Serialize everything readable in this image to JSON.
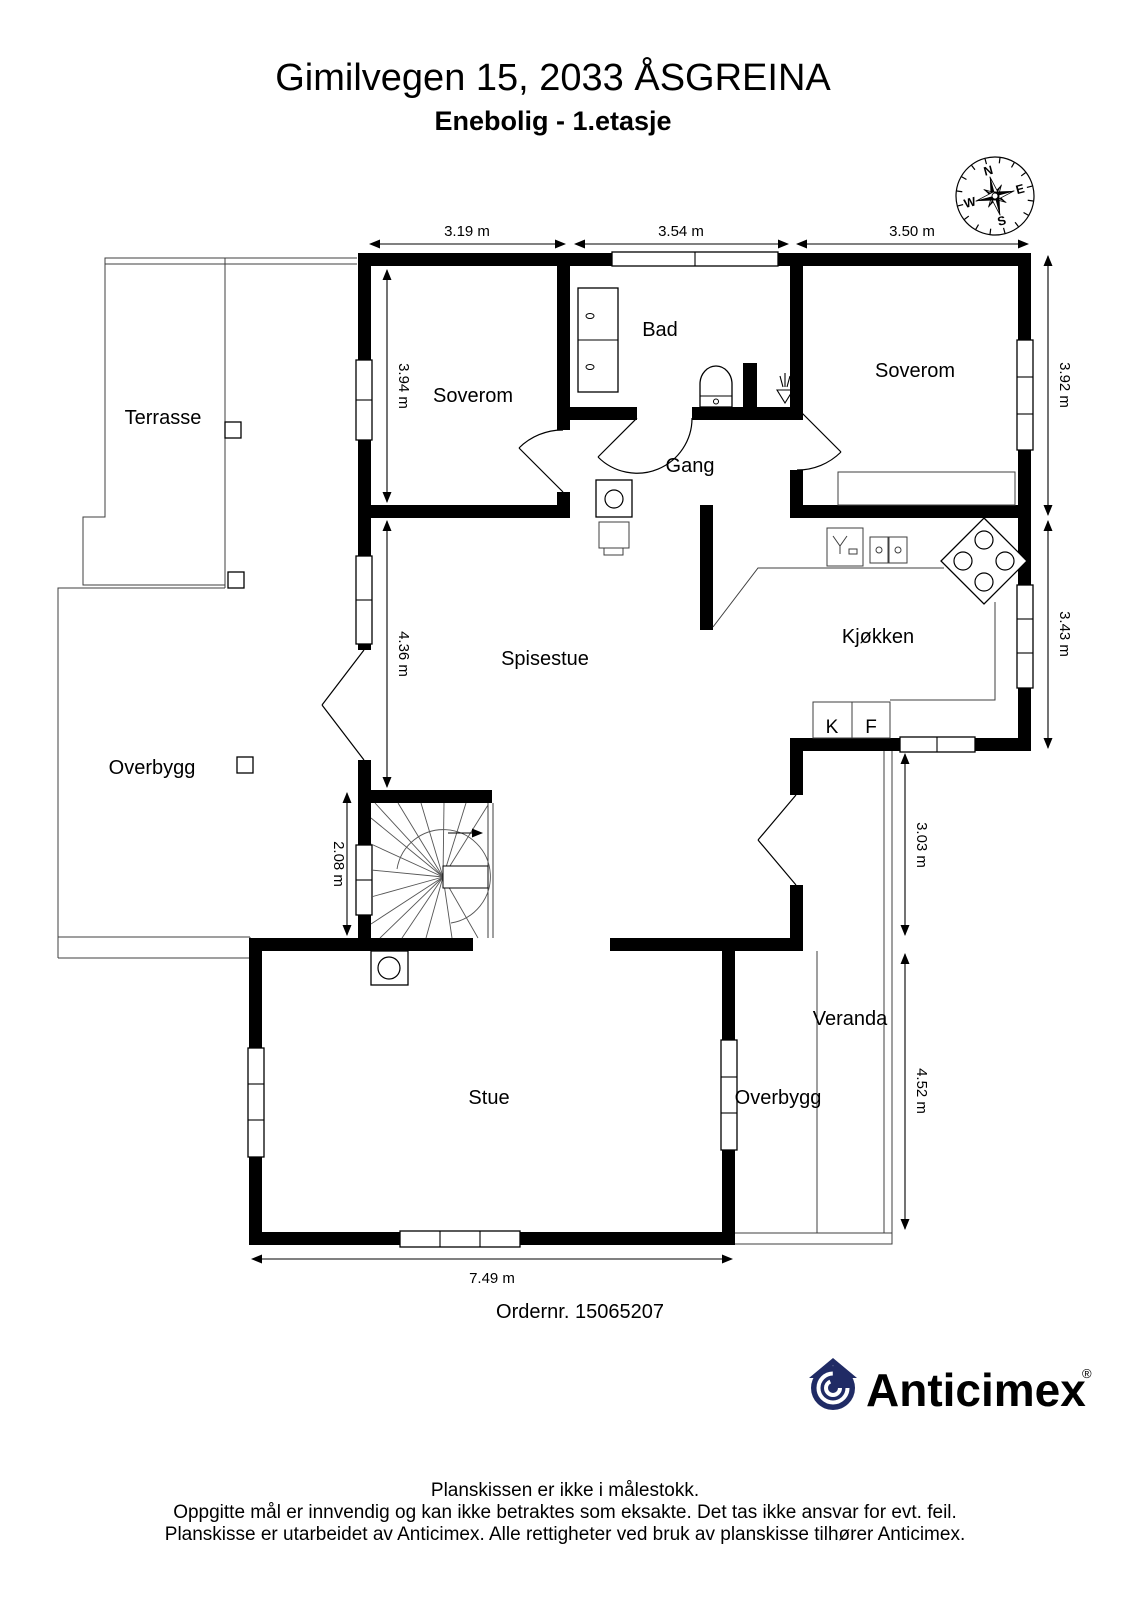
{
  "header": {
    "title": "Gimilvegen 15, 2033 ÅSGREINA",
    "subtitle": "Enebolig - 1.etasje"
  },
  "compass": {
    "north": "N",
    "east": "E",
    "south": "S",
    "west": "W"
  },
  "rooms": {
    "terrace": "Terrasse",
    "bedroom_left": "Soverom",
    "bathroom": "Bad",
    "bedroom_right": "Soverom",
    "hallway": "Gang",
    "dining": "Spisestue",
    "kitchen": "Kjøkken",
    "covered_left": "Overbygg",
    "living": "Stue",
    "veranda": "Veranda",
    "covered_right": "Overbygg"
  },
  "kitchen_appliances": {
    "fridge": "K",
    "freezer": "F"
  },
  "dimensions": {
    "top_left": "3.19 m",
    "top_middle": "3.54 m",
    "top_right": "3.50 m",
    "bedroom_left_depth": "3.94 m",
    "bedroom_right_depth": "3.92 m",
    "dining_depth": "4.36 m",
    "kitchen_depth": "3.43 m",
    "stairs_depth": "2.08 m",
    "veranda_upper": "3.03 m",
    "veranda_lower": "4.52 m",
    "living_width": "7.49 m"
  },
  "order_number": "Ordernr. 15065207",
  "brand": {
    "name": "Anticimex",
    "registered": "®",
    "navy": "#202b65"
  },
  "icons": [
    "compass-rose-icon",
    "toilet-icon",
    "shower-drain-icon",
    "bath-cabinet-icon",
    "sink-icon",
    "double-sink-icon",
    "stove-icon",
    "fridge-box",
    "freezer-box",
    "stair-winder-icon",
    "fireplace-icon",
    "wood-stove-icon",
    "anticimex-house-icon"
  ],
  "colors": {
    "walls": "#000000",
    "thin_lines": "#3f3f3f",
    "brand_navy": "#202b65"
  },
  "footer": {
    "line1": "Planskissen er ikke i målestokk.",
    "line2": "Oppgitte mål er innvendig og kan ikke betraktes som eksakte. Det tas ikke ansvar for evt. feil.",
    "line3": "Planskisse er utarbeidet av Anticimex. Alle rettigheter ved bruk av planskisse tilhører Anticimex."
  }
}
